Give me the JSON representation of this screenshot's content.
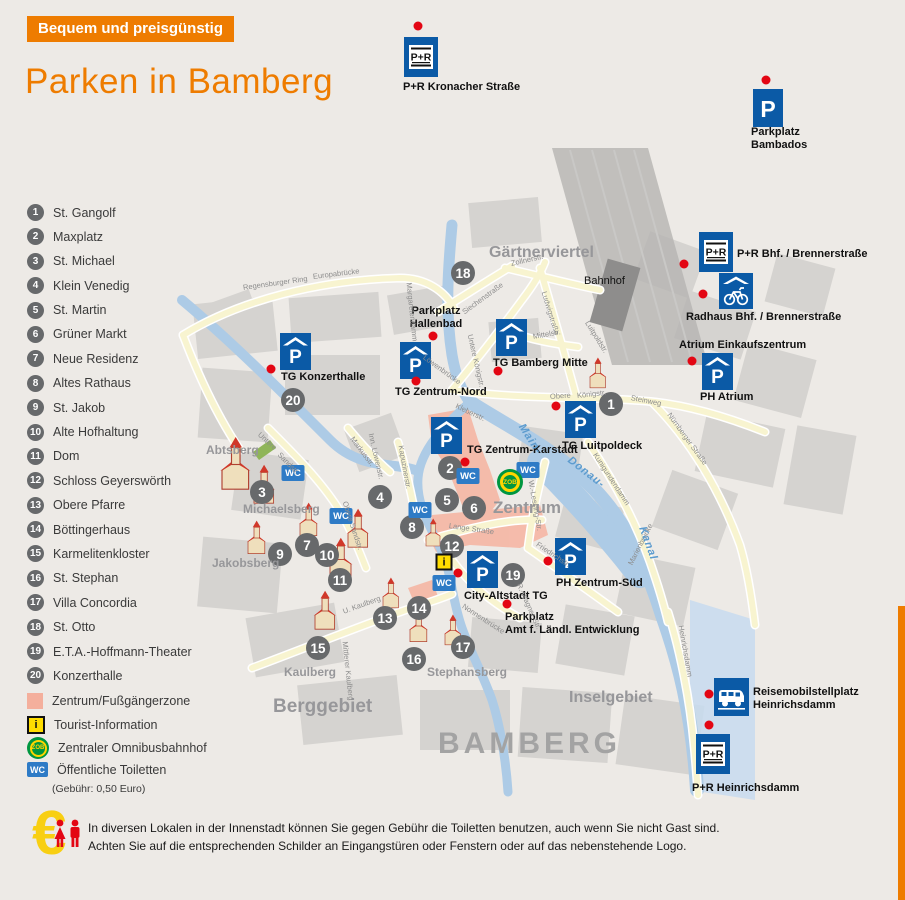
{
  "badge": {
    "label": "Bequem und preisgünstig"
  },
  "title": "Parken in Bamberg",
  "colors": {
    "accent_orange": "#EE7C00",
    "parking_blue": "#0B5AA6",
    "wc_blue": "#2E7BC6",
    "dot_red": "#E30613",
    "zone_pink": "#F4AF9C",
    "zob_green": "#009640",
    "zob_yellow": "#FFD500",
    "info_yellow": "#FFDD00"
  },
  "icon_letters": {
    "p": "P",
    "pr": "P+R",
    "wc": "WC",
    "zob": "ZOB",
    "info": "i"
  },
  "legend": {
    "numbered": [
      {
        "n": "1",
        "label": "St. Gangolf"
      },
      {
        "n": "2",
        "label": "Maxplatz"
      },
      {
        "n": "3",
        "label": "St. Michael"
      },
      {
        "n": "4",
        "label": "Klein Venedig"
      },
      {
        "n": "5",
        "label": "St. Martin"
      },
      {
        "n": "6",
        "label": "Grüner Markt"
      },
      {
        "n": "7",
        "label": "Neue Residenz"
      },
      {
        "n": "8",
        "label": "Altes Rathaus"
      },
      {
        "n": "9",
        "label": "St. Jakob"
      },
      {
        "n": "10",
        "label": "Alte Hofhaltung"
      },
      {
        "n": "11",
        "label": "Dom"
      },
      {
        "n": "12",
        "label": "Schloss Geyerswörth"
      },
      {
        "n": "13",
        "label": "Obere Pfarre"
      },
      {
        "n": "14",
        "label": "Böttingerhaus"
      },
      {
        "n": "15",
        "label": "Karmelitenkloster"
      },
      {
        "n": "16",
        "label": "St. Stephan"
      },
      {
        "n": "17",
        "label": "Villa Concordia"
      },
      {
        "n": "18",
        "label": "St. Otto"
      },
      {
        "n": "19",
        "label": "E.T.A.-Hoffmann-Theater"
      },
      {
        "n": "20",
        "label": "Konzerthalle"
      }
    ],
    "symbols": {
      "zone": "Zentrum/Fußgängerzone",
      "info": "Tourist-Information",
      "zob": "Zentraler Omnibusbahnhof",
      "wc": "Öffentliche Toiletten",
      "wc_sub": "(Gebühr: 0,50 Euro)"
    }
  },
  "footer": {
    "line1": "In diversen Lokalen in der Innenstadt können Sie gegen Gebühr die Toiletten benutzen, auch wenn Sie nicht Gast sind.",
    "line2": "Achten Sie auf die entsprechenden Schilder an Eingangstüren oder Fenstern oder auf das nebenstehende Logo."
  },
  "map": {
    "city_label": {
      "text": "BAMBERG",
      "x": 438,
      "y": 727,
      "size": 30
    },
    "regions": [
      {
        "text": "Gärtnerviertel",
        "x": 489,
        "y": 244,
        "size": 16
      },
      {
        "text": "Zentrum",
        "x": 493,
        "y": 498,
        "size": 17
      },
      {
        "text": "Berggebiet",
        "x": 273,
        "y": 696,
        "size": 19
      },
      {
        "text": "Inselgebiet",
        "x": 569,
        "y": 689,
        "size": 16
      },
      {
        "text": "Abtsberg",
        "x": 206,
        "y": 443,
        "size": 12
      },
      {
        "text": "Michaelsberg",
        "x": 243,
        "y": 502,
        "size": 12
      },
      {
        "text": "Jakobsberg",
        "x": 212,
        "y": 556,
        "size": 12
      },
      {
        "text": "Kaulberg",
        "x": 284,
        "y": 665,
        "size": 12
      },
      {
        "text": "Stephansberg",
        "x": 427,
        "y": 665,
        "size": 12
      }
    ],
    "water_labels": [
      {
        "text": "Main-",
        "x": 521,
        "y": 419,
        "rot": 57
      },
      {
        "text": "Donau-",
        "x": 569,
        "y": 453,
        "rot": 38
      },
      {
        "text": "Kanal",
        "x": 642,
        "y": 521,
        "rot": 70
      }
    ],
    "streets": [
      {
        "text": "Regensburger Ring",
        "x": 243,
        "y": 283,
        "rot": -8
      },
      {
        "text": "Europabrücke",
        "x": 313,
        "y": 272,
        "rot": -7
      },
      {
        "text": "Margaretendamm",
        "x": 409,
        "y": 278,
        "rot": 84
      },
      {
        "text": "Siechenstraße",
        "x": 463,
        "y": 308,
        "rot": -36
      },
      {
        "text": "Zollnerstr.",
        "x": 511,
        "y": 259,
        "rot": -13
      },
      {
        "text": "Ludwigstraße",
        "x": 544,
        "y": 287,
        "rot": 73
      },
      {
        "text": "Mittelstr.",
        "x": 533,
        "y": 332,
        "rot": -10
      },
      {
        "text": "Luitpoldstr.",
        "x": 587,
        "y": 317,
        "rot": 58
      },
      {
        "text": "Obere",
        "x": 550,
        "y": 392,
        "rot": -4
      },
      {
        "text": "Königstr.",
        "x": 577,
        "y": 391,
        "rot": -6
      },
      {
        "text": "Steinweg",
        "x": 631,
        "y": 393,
        "rot": 11
      },
      {
        "text": "Nürnberger Straße",
        "x": 669,
        "y": 409,
        "rot": 54
      },
      {
        "text": "Untere Königstr.",
        "x": 470,
        "y": 330,
        "rot": 77
      },
      {
        "text": "Löwenbrücke",
        "x": 424,
        "y": 352,
        "rot": 36
      },
      {
        "text": "Kleberstr.",
        "x": 456,
        "y": 401,
        "rot": 25
      },
      {
        "text": "Markusstr.",
        "x": 352,
        "y": 433,
        "rot": 53
      },
      {
        "text": "Inn. Löwenstr.",
        "x": 371,
        "y": 429,
        "rot": 77
      },
      {
        "text": "Kapuzinerstr.",
        "x": 401,
        "y": 441,
        "rot": 80
      },
      {
        "text": "Untere",
        "x": 259,
        "y": 429,
        "rot": 42
      },
      {
        "text": "Sandstr.",
        "x": 279,
        "y": 449,
        "rot": 46
      },
      {
        "text": "Obere Sandstr.",
        "x": 345,
        "y": 497,
        "rot": 72
      },
      {
        "text": "Lange Straße",
        "x": 449,
        "y": 521,
        "rot": 8
      },
      {
        "text": "W.-Lessing-Str.",
        "x": 531,
        "y": 476,
        "rot": 80
      },
      {
        "text": "Friedrichstr.",
        "x": 537,
        "y": 539,
        "rot": 34
      },
      {
        "text": "Kunigundendamm",
        "x": 595,
        "y": 449,
        "rot": 57
      },
      {
        "text": "Marienbrücke",
        "x": 630,
        "y": 560,
        "rot": -63
      },
      {
        "text": "Nonnenbrücke",
        "x": 463,
        "y": 601,
        "rot": 33
      },
      {
        "text": "R.-Wagner-Str.",
        "x": 519,
        "y": 579,
        "rot": 66
      },
      {
        "text": "U. Kaulberg",
        "x": 343,
        "y": 607,
        "rot": -20
      },
      {
        "text": "Mittlerer Kaulberg",
        "x": 345,
        "y": 637,
        "rot": 84
      },
      {
        "text": "Heinrichsdamm",
        "x": 681,
        "y": 621,
        "rot": 80
      }
    ],
    "parkings": [
      {
        "kind": "pr",
        "lines": [
          "P+R Kronacher Straße"
        ],
        "icon": [
          404,
          37
        ],
        "label": [
          403,
          81
        ],
        "dot": [
          418,
          26
        ]
      },
      {
        "kind": "p",
        "lines": [
          "Parkplatz",
          "Bambados"
        ],
        "icon": [
          753,
          89
        ],
        "label": [
          751,
          126
        ],
        "dot": [
          766,
          80
        ]
      },
      {
        "kind": "pr",
        "lines": [
          "P+R Bhf. / Brennerstraße"
        ],
        "icon": [
          699,
          232
        ],
        "label": [
          737,
          248
        ],
        "dot": [
          684,
          264
        ]
      },
      {
        "kind": "bike",
        "lines": [
          "Radhaus Bhf. / Brennerstraße"
        ],
        "icon": [
          719,
          273
        ],
        "label": [
          686,
          311
        ],
        "dot": [
          703,
          294
        ]
      },
      {
        "kind": "garage",
        "lines": [
          "TG Konzerthalle"
        ],
        "icon": [
          280,
          333
        ],
        "label": [
          281,
          371
        ],
        "dot": [
          271,
          369
        ]
      },
      {
        "kind": "garage",
        "lines": [
          "TG Zentrum-Nord"
        ],
        "icon": [
          400,
          342
        ],
        "label": [
          395,
          386
        ],
        "dot": [
          416,
          381
        ]
      },
      {
        "kind": "garage",
        "lines": [
          "TG Bamberg Mitte"
        ],
        "icon": [
          496,
          319
        ],
        "label": [
          493,
          357
        ],
        "dot": [
          498,
          371
        ]
      },
      {
        "kind": "garage",
        "lines": [
          "TG Zentrum-Karstadt"
        ],
        "icon": [
          431,
          417
        ],
        "label": [
          467,
          444
        ],
        "dot": [
          465,
          462
        ]
      },
      {
        "kind": "garage",
        "lines": [
          "TG Luitpoldeck"
        ],
        "icon": [
          565,
          401
        ],
        "label": [
          562,
          440
        ],
        "dot": [
          556,
          406
        ]
      },
      {
        "kind": "garage",
        "lines": [
          "PH Atrium"
        ],
        "icon": [
          702,
          353
        ],
        "label": [
          700,
          391
        ],
        "dot": [
          692,
          361
        ]
      },
      {
        "kind": "garage",
        "lines": [
          "City-Altstadt TG"
        ],
        "icon": [
          467,
          551
        ],
        "label": [
          464,
          590
        ],
        "dot": [
          458,
          573
        ]
      },
      {
        "kind": "garage",
        "lines": [
          "PH Zentrum-Süd"
        ],
        "icon": [
          555,
          538
        ],
        "label": [
          556,
          577
        ],
        "dot": [
          548,
          561
        ]
      },
      {
        "kind": "pr",
        "lines": [
          "P+R Heinrichsdamm"
        ],
        "icon": [
          696,
          734
        ],
        "label": [
          692,
          782
        ],
        "dot": [
          709,
          725
        ]
      },
      {
        "kind": "camper",
        "lines": [
          "Reisemobilstellplatz",
          "Heinrichsdamm"
        ],
        "icon": [
          714,
          678
        ],
        "label": [
          753,
          686
        ],
        "dot": [
          709,
          694
        ]
      },
      {
        "kind": "dot",
        "lines": [
          "Parkplatz",
          "Hallenbad"
        ],
        "label": [
          436,
          305
        ],
        "dot": [
          433,
          336
        ],
        "center": true
      },
      {
        "kind": "dot",
        "lines": [
          "Parkplatz",
          "Amt f. Ländl. Entwicklung"
        ],
        "label": [
          505,
          611
        ],
        "dot": [
          507,
          604
        ]
      },
      {
        "kind": "plain",
        "lines": [
          "Atrium Einkaufszentrum"
        ],
        "label": [
          679,
          339
        ]
      },
      {
        "kind": "plain",
        "lines": [
          "Bahnhof"
        ],
        "label": [
          584,
          275
        ],
        "plain": true
      }
    ],
    "markers": [
      {
        "n": "1",
        "x": 611,
        "y": 404
      },
      {
        "n": "2",
        "x": 450,
        "y": 468
      },
      {
        "n": "3",
        "x": 262,
        "y": 492
      },
      {
        "n": "4",
        "x": 380,
        "y": 497
      },
      {
        "n": "5",
        "x": 447,
        "y": 500
      },
      {
        "n": "6",
        "x": 474,
        "y": 508
      },
      {
        "n": "7",
        "x": 307,
        "y": 545
      },
      {
        "n": "8",
        "x": 412,
        "y": 527
      },
      {
        "n": "9",
        "x": 280,
        "y": 554
      },
      {
        "n": "10",
        "x": 327,
        "y": 555
      },
      {
        "n": "11",
        "x": 340,
        "y": 580
      },
      {
        "n": "12",
        "x": 452,
        "y": 546
      },
      {
        "n": "13",
        "x": 385,
        "y": 618
      },
      {
        "n": "14",
        "x": 419,
        "y": 608
      },
      {
        "n": "15",
        "x": 318,
        "y": 648
      },
      {
        "n": "16",
        "x": 414,
        "y": 659
      },
      {
        "n": "17",
        "x": 463,
        "y": 647
      },
      {
        "n": "18",
        "x": 463,
        "y": 273
      },
      {
        "n": "19",
        "x": 513,
        "y": 575
      },
      {
        "n": "20",
        "x": 293,
        "y": 400
      }
    ],
    "wc_points": [
      {
        "x": 293,
        "y": 473
      },
      {
        "x": 341,
        "y": 516
      },
      {
        "x": 420,
        "y": 510
      },
      {
        "x": 468,
        "y": 476
      },
      {
        "x": 528,
        "y": 470
      },
      {
        "x": 444,
        "y": 583
      }
    ],
    "info_point": {
      "x": 444,
      "y": 562
    },
    "zob_point": {
      "x": 510,
      "y": 482
    }
  }
}
